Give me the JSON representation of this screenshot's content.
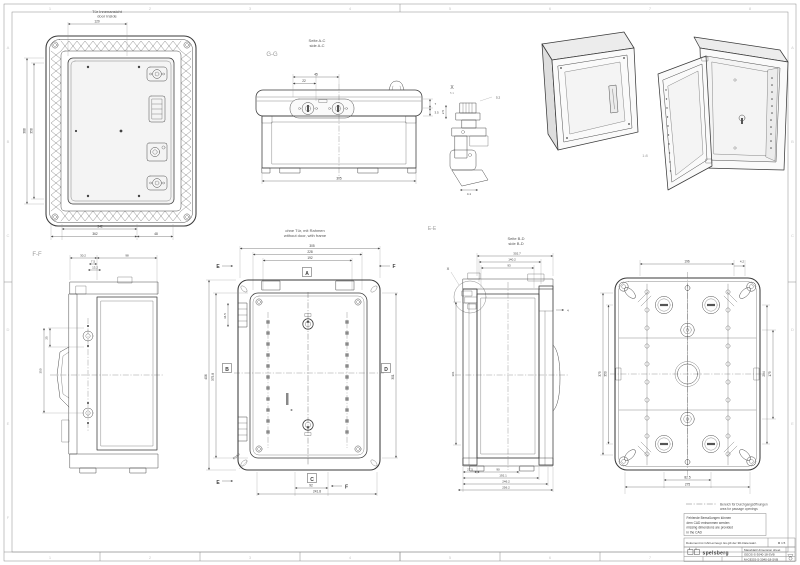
{
  "zones": {
    "cols": [
      "1",
      "2",
      "3",
      "4",
      "5",
      "6",
      "7",
      "8"
    ],
    "rows": [
      "A",
      "B",
      "C",
      "D",
      "E",
      "F"
    ]
  },
  "views": {
    "door": {
      "title_de": "Tür Innenansicht",
      "title_en": "door inside",
      "dim_top": "120",
      "dim_left_outer": "388",
      "dim_left_inner": "358",
      "dim_bottom_inner": "342",
      "dim_bottom_outer": "362",
      "dim_bottom_right": "48"
    },
    "gg": {
      "label": "G-G",
      "head_de": "Seite A-C",
      "head_en": "side A-C",
      "dim1": "45",
      "dim2": "22",
      "dim_r1": "7",
      "dim_r2": "3.5",
      "dim_bottom": "305"
    },
    "iso": {
      "scale": "1:8"
    },
    "detail_x": {
      "label": "X",
      "scale": "5:1",
      "dim1": "2.5",
      "dim2": "5.2",
      "dim3": "4.1"
    },
    "ff": {
      "label": "F-F",
      "dim1": "30.2",
      "dim2": "7.5",
      "dim3": "13.2",
      "dim4": "98",
      "dim5": "25",
      "dim6": "350"
    },
    "front": {
      "head_de": "ohne Tür, mit Rahmen",
      "head_en": "without door, with frame",
      "m_a": "A",
      "m_b": "B",
      "m_c": "C",
      "m_d": "D",
      "cut_e": "E",
      "cut_f": "F",
      "dim_t1": "305",
      "dim_t2": "228",
      "dim_t3": "192",
      "dim_l1": "406",
      "dim_l2": "375.8",
      "dim_l3": "34.5",
      "dim_r1": "301",
      "dim_b1": "92",
      "dim_b2": "241.8",
      "radius": "R14.5"
    },
    "ee": {
      "label": "E-E",
      "head_de": "Seite B-D",
      "head_en": "side B-D",
      "callout": "X",
      "dim_t1": "302.7",
      "dim_t2": "140.2",
      "dim_t3": "93",
      "dim_l1": "301",
      "dim_r1": "4",
      "dim_b1": "27.5",
      "dim_b2": "90",
      "dim_b3": "192.1",
      "dim_b4": "246.2",
      "dim_b5": "256.2"
    },
    "back": {
      "dim_t1": "196",
      "dim_t2": "4.2",
      "dim_l1": "375",
      "dim_l2": "350",
      "dim_r1": "254",
      "dim_r2": "175",
      "dim_b1": "82.5",
      "dim_b2": "275"
    }
  },
  "notes": {
    "legend_de": "Bereich für Durchgangsöffnungen",
    "legend_en": "area for passage openings",
    "box1": "Fehlende Bemaßungen können",
    "box2": "dem CAD entnommen werden",
    "box3": "missing dimensions are provided",
    "box4": "in the CAD",
    "strip": "Dokument ist CAD-erzeugt. Es gilt der 3D-Datensatz.",
    "scale": "M 1:5"
  },
  "titleblock": {
    "brand": "spelsberg",
    "title": "Massblatt/ dimension sheet",
    "line2": "GEOS-S-3040-18-SVB",
    "line3": "M-GEOS-S-3040-18-SVB"
  }
}
